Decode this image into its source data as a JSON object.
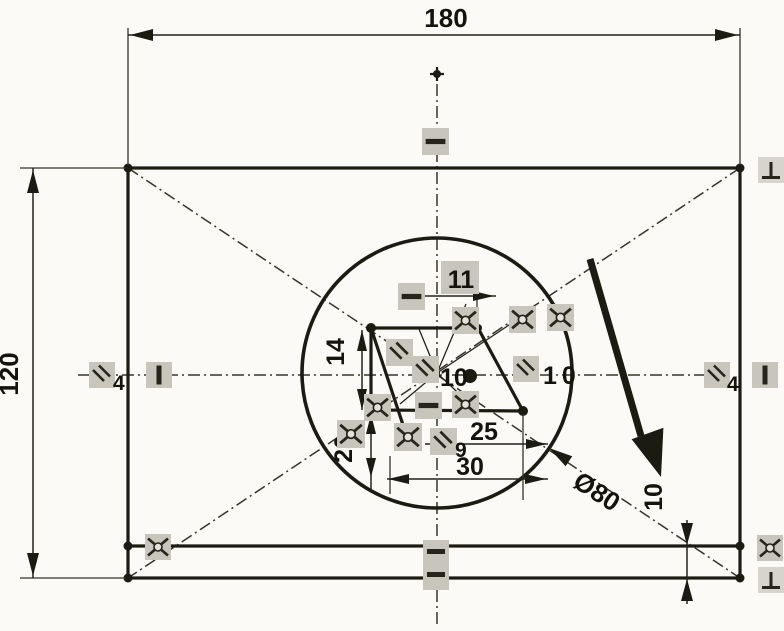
{
  "drawing": {
    "dimensions": {
      "outer_width": "180",
      "outer_height": "120",
      "inner_top_width": "11",
      "inner_left_height": "14",
      "inner_lower_height": "20",
      "inner_mid_width": "25",
      "inner_bottom_width": "30",
      "circle_diameter": "Ø80",
      "bottom_strip_height": "10"
    },
    "constraint_badges": {
      "parallel_left": "4",
      "parallel_right": "4",
      "parallel_center": "10",
      "parallel_mid": "10",
      "parallel_lower": "9"
    },
    "icons": {
      "parallel_icon": "double-diagonal-lines",
      "coincident_icon": "x-cross-with-circle",
      "perpendicular_icon": "inverted-T",
      "horizontal_icon": "horizontal-bar",
      "vertical_icon": "vertical-bar"
    }
  }
}
